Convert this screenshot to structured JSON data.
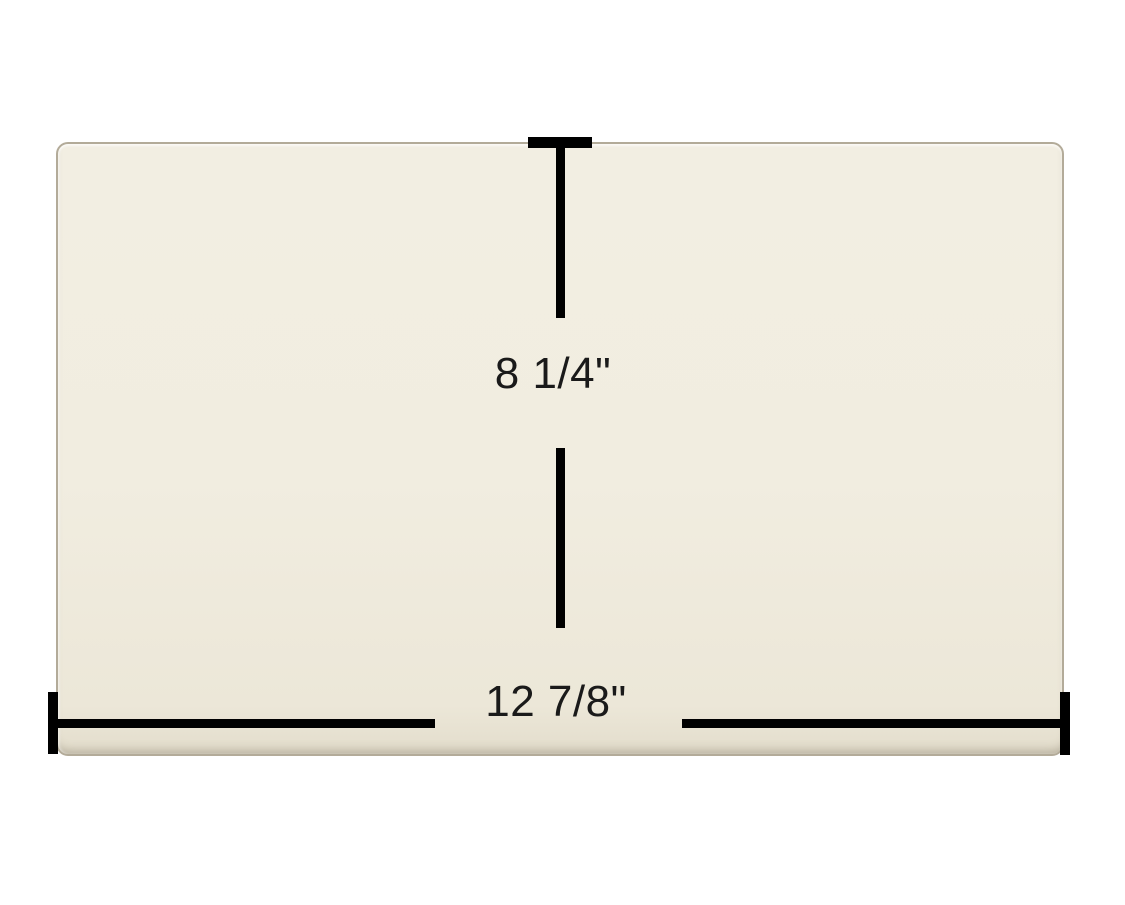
{
  "product": {
    "shape": "rectangular glass panel with rounded corners"
  },
  "dimensions": {
    "height_label": "8 1/4\"",
    "width_label": "12 7/8\""
  },
  "colors": {
    "background": "#ffffff",
    "glass_fill": "#f1ede0",
    "glass_edge": "#b3ab99",
    "dimension_line": "#000000",
    "label_text": "#1a1a1a"
  }
}
